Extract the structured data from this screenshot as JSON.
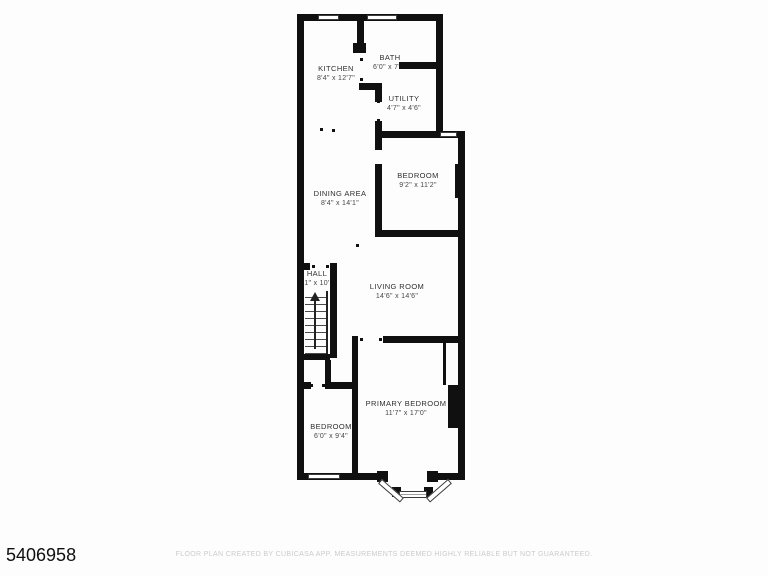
{
  "meta": {
    "listing_id": "5406958",
    "disclaimer": "FLOOR PLAN CREATED BY CUBICASA APP. MEASUREMENTS DEEMED HIGHLY RELIABLE BUT NOT GUARANTEED."
  },
  "colors": {
    "background": "#fdfdfd",
    "wall": "#101010",
    "room_label": "#2f2f2f",
    "room_dims": "#464646",
    "disclaimer_text": "#cbcbcb"
  },
  "rooms": {
    "kitchen": {
      "name": "KITCHEN",
      "dims": "8'4\" x 12'7\""
    },
    "bath": {
      "name": "BATH",
      "dims": "6'0\" x 7'5\""
    },
    "utility": {
      "name": "UTILITY",
      "dims": "4'7\" x 4'6\""
    },
    "bedroom1": {
      "name": "BEDROOM",
      "dims": "9'2\" x 11'2\""
    },
    "dining": {
      "name": "DINING AREA",
      "dims": "8'4\" x 14'1\""
    },
    "hall": {
      "name": "HALL",
      "dims": "1\" x 10'"
    },
    "living": {
      "name": "LIVING ROOM",
      "dims": "14'6\" x 14'6\""
    },
    "bedroom2": {
      "name": "BEDROOM",
      "dims": "6'0\" x 9'4\""
    },
    "primary": {
      "name": "PRIMARY BEDROOM",
      "dims": "11'7\" x 17'0\""
    }
  }
}
